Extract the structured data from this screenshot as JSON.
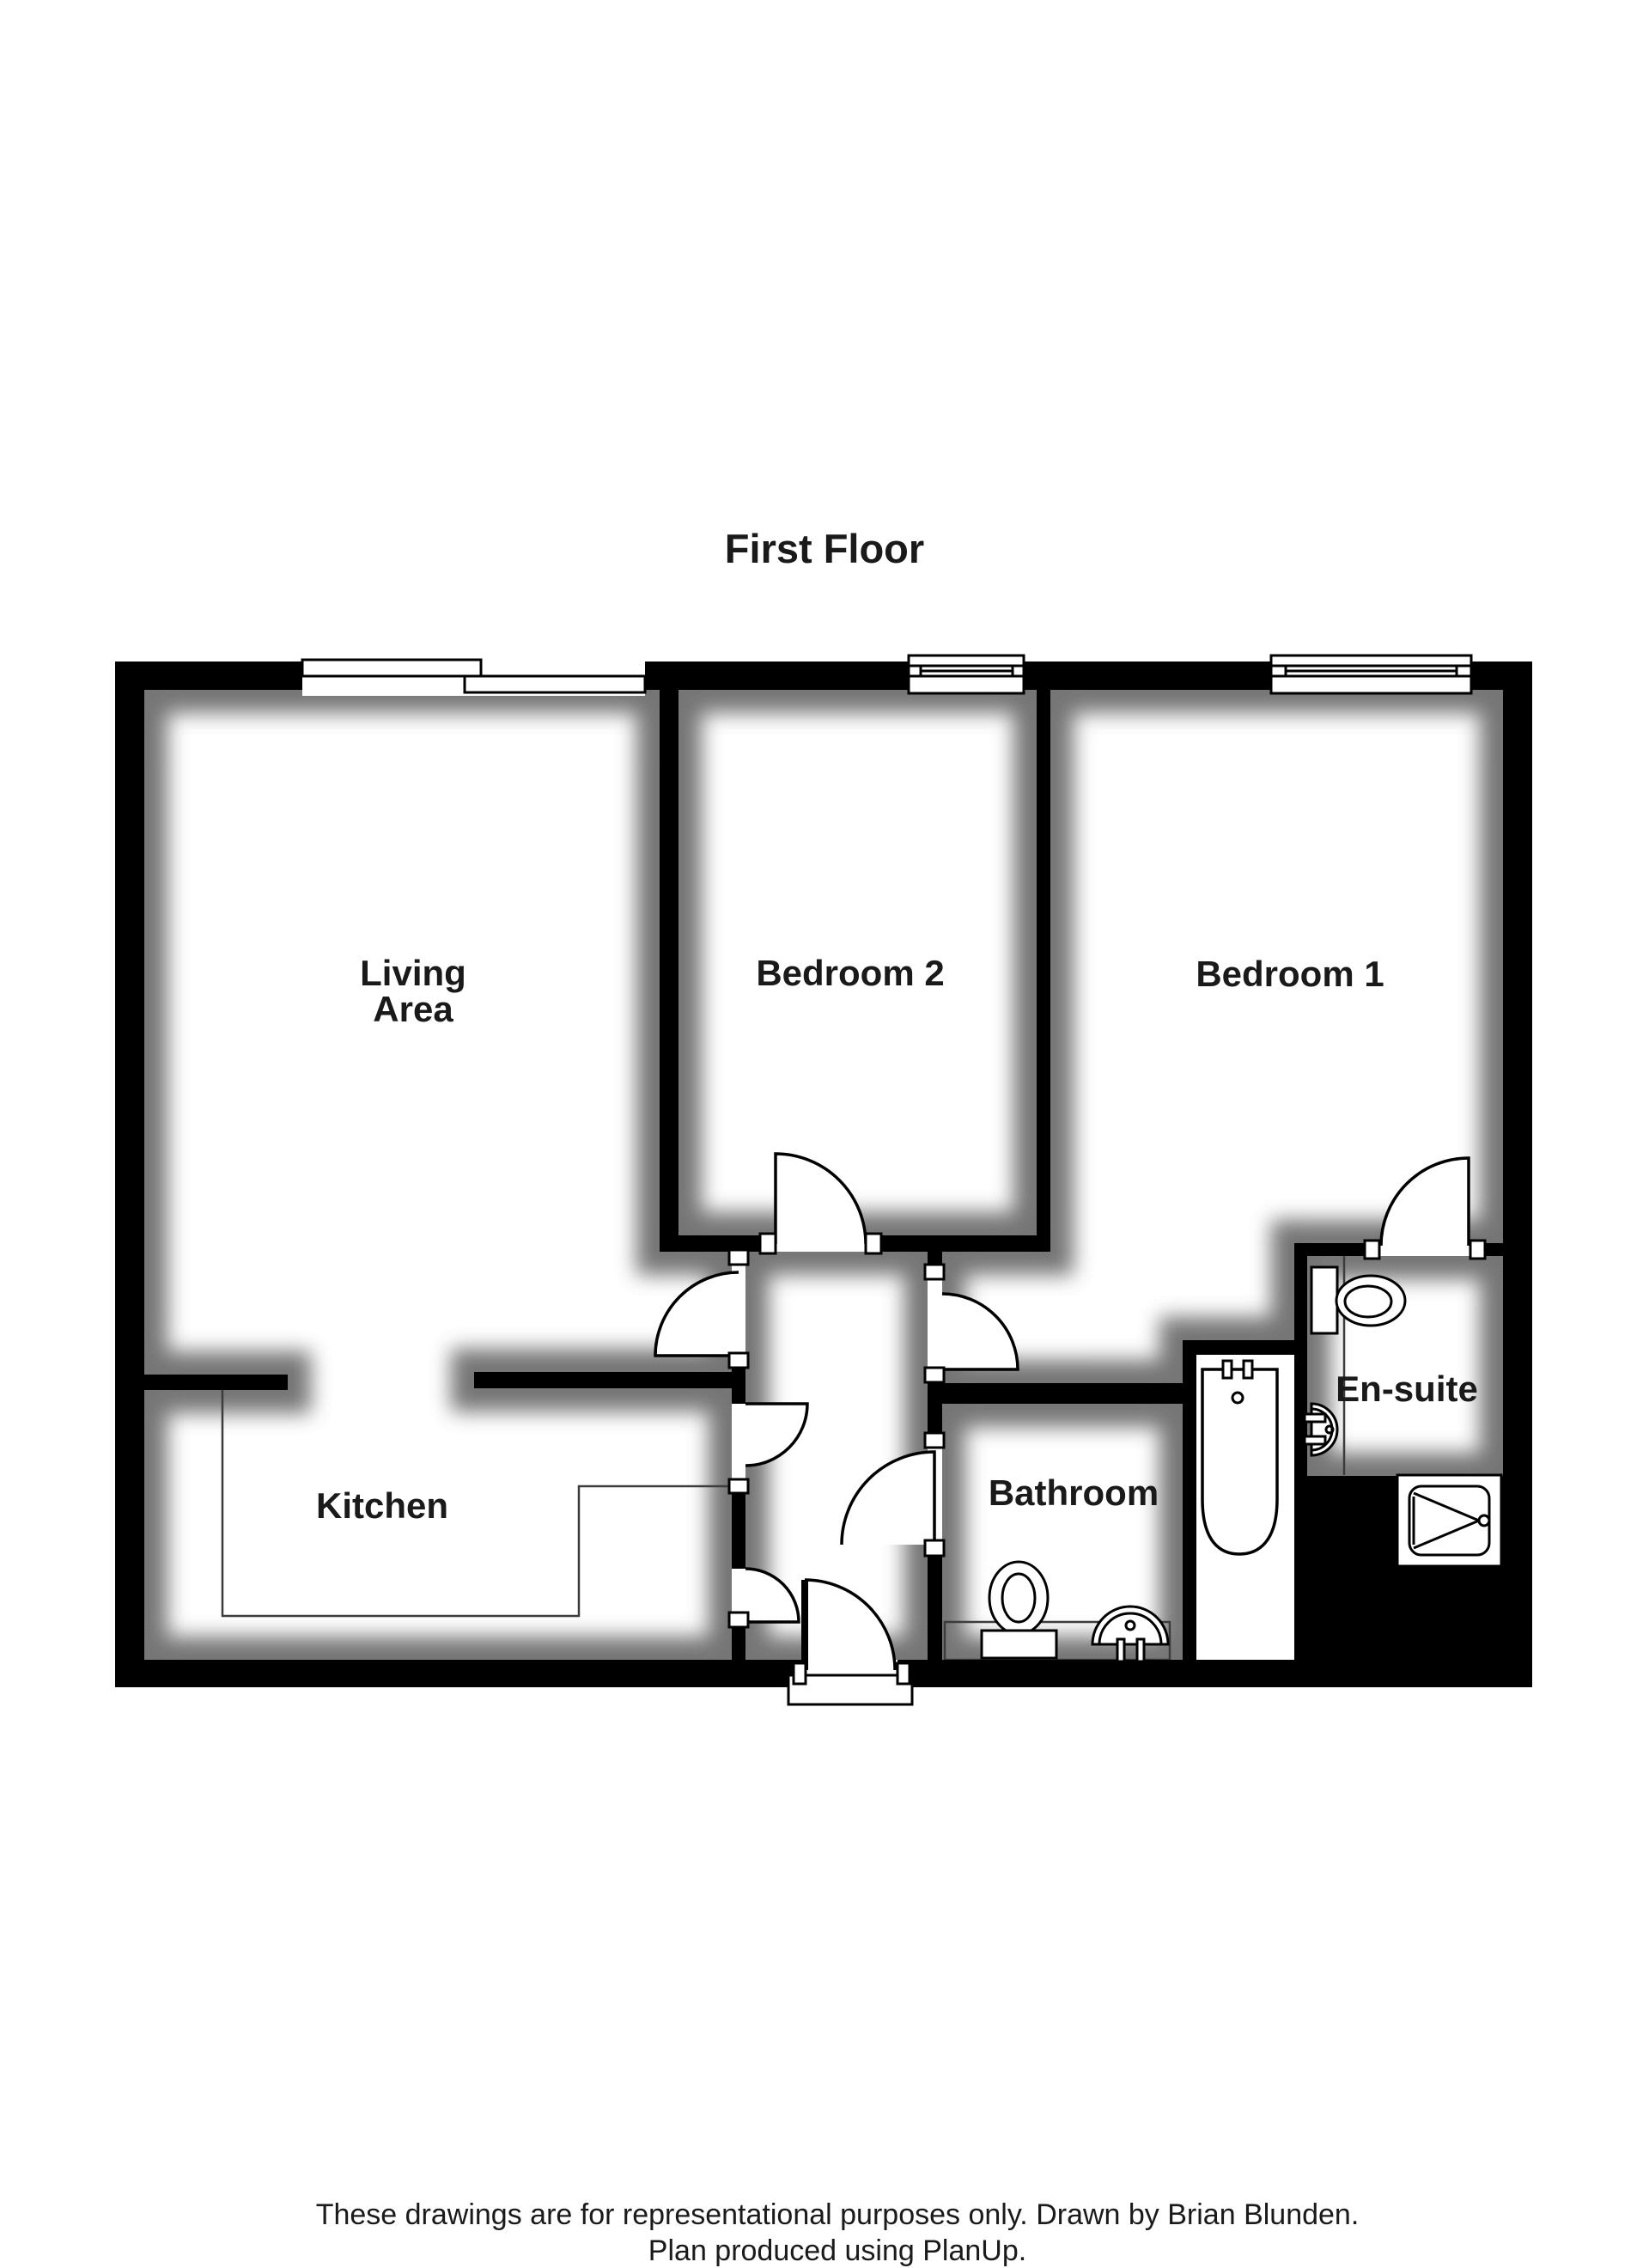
{
  "title": "First Floor",
  "rooms": {
    "living": {
      "line1": "Living",
      "line2": "Area"
    },
    "bedroom2": {
      "label": "Bedroom 2"
    },
    "bedroom1": {
      "label": "Bedroom 1"
    },
    "kitchen": {
      "label": "Kitchen"
    },
    "bathroom": {
      "label": "Bathroom"
    },
    "ensuite": {
      "label": "En-suite"
    }
  },
  "footer": {
    "line1": "These drawings are for representational purposes only. Drawn by Brian Blunden.",
    "line2": "Plan produced using PlanUp."
  },
  "colors": {
    "wall": "#000000",
    "paper": "#ffffff",
    "shadow": "#4f4f4f",
    "text": "#1a1a1a"
  }
}
